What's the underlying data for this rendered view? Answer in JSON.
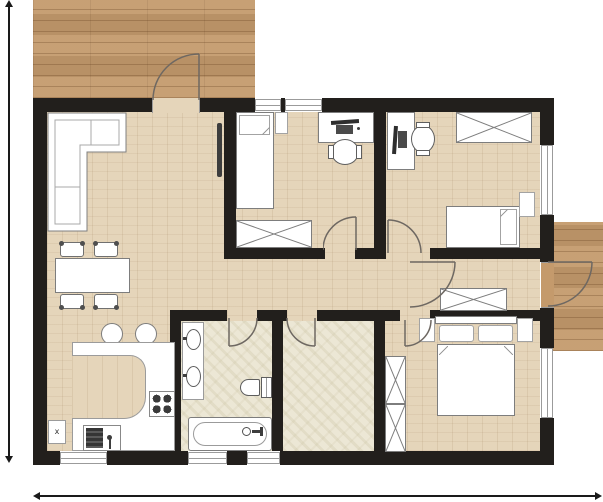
{
  "labels": {
    "kitchen_box": "x"
  },
  "colors": {
    "wall": "#221f1c",
    "wood": "#e5d5ba",
    "tile": "#ece7d5",
    "deck": "#c49a6c",
    "arc": "#6e6862",
    "dim": "#1a1a1a",
    "furniture_outline": "#7d7d7d",
    "furniture_fill": "#ffffff"
  },
  "openings": {
    "window_panes": 7,
    "doors": 8
  },
  "rooms": [
    {
      "id": "living-dining-kitchen",
      "furniture": [
        "corner-sofa",
        "wall-tv",
        "dining-table",
        "dining-chair",
        "dining-chair",
        "dining-chair",
        "dining-chair",
        "bar-stool",
        "bar-stool",
        "kitchen-counter",
        "stove",
        "kitchen-sink",
        "kitchen-box"
      ]
    },
    {
      "id": "bedroom-top-left",
      "furniture": [
        "single-bed",
        "nightstand",
        "desk",
        "desk-chair",
        "wardrobe"
      ]
    },
    {
      "id": "bedroom-top-right",
      "furniture": [
        "desk",
        "desk-chair",
        "wardrobe",
        "single-bed",
        "nightstand"
      ]
    },
    {
      "id": "hallway",
      "furniture": [
        "wardrobe"
      ]
    },
    {
      "id": "bathroom",
      "furniture": [
        "double-washbasin",
        "toilet",
        "bathtub"
      ]
    },
    {
      "id": "storage-room",
      "furniture": []
    },
    {
      "id": "bedroom-master",
      "furniture": [
        "double-bed",
        "nightstand",
        "nightstand",
        "wardrobe",
        "wardrobe"
      ]
    },
    {
      "id": "terrace-top-left",
      "furniture": []
    },
    {
      "id": "terrace-right",
      "furniture": []
    }
  ]
}
